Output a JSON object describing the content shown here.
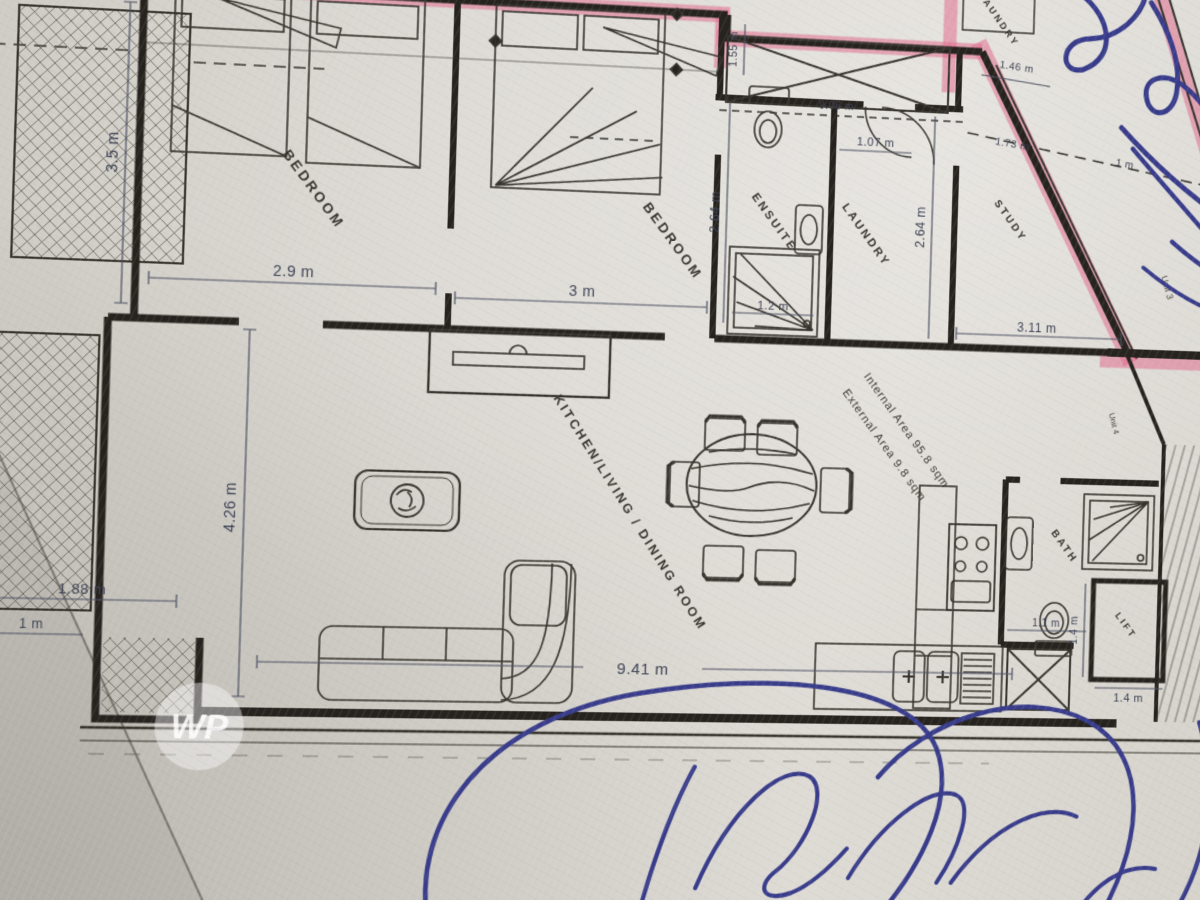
{
  "plan": {
    "rooms": {
      "bedroom1": "BEDROOM",
      "bedroom2": "BEDROOM",
      "ensuite": "ENSUITE",
      "laundry": "LAUNDRY",
      "study": "STUDY",
      "kitchen_living": "KITCHEN/LIVING / DINING ROOM",
      "bath": "BATH",
      "lift": "LIFT",
      "laundry_upper": "LAUNDRY"
    },
    "dims": {
      "bedroom1_height": "3.5 m",
      "bedroom1_width": "2.9 m",
      "bedroom2_width": "3 m",
      "ensuite_height": "2.64 m",
      "laundry_door": "1.07 m",
      "shower_width": "1.2 m",
      "void_height": "1.55 m",
      "top_span": "9.06 m",
      "top_right_a": "1.46 m",
      "top_right_b": "1.73 m",
      "top_right_c": "1 m",
      "study_height": "2.64 m",
      "study_width": "3.11 m",
      "living_height": "4.26 m",
      "terrace_width": "1.88 m",
      "terrace_depth": "1 m",
      "living_width": "9.41 m",
      "bath_width": "1.1 m",
      "lift_height": "1.4 m",
      "lift_width": "1.4 m"
    },
    "annotations": {
      "internal_area": "Internal Area 95.8 sqm",
      "external_area": "External Area 9.8 sqm",
      "unit3": "Unit 3",
      "unit4": "Unit 4",
      "watermark": "WP"
    },
    "colors": {
      "paper": "#d9d6d0",
      "ink": "#26231f",
      "highlighter_pink": "#e0688a",
      "pen_blue": "#383c8a"
    }
  }
}
